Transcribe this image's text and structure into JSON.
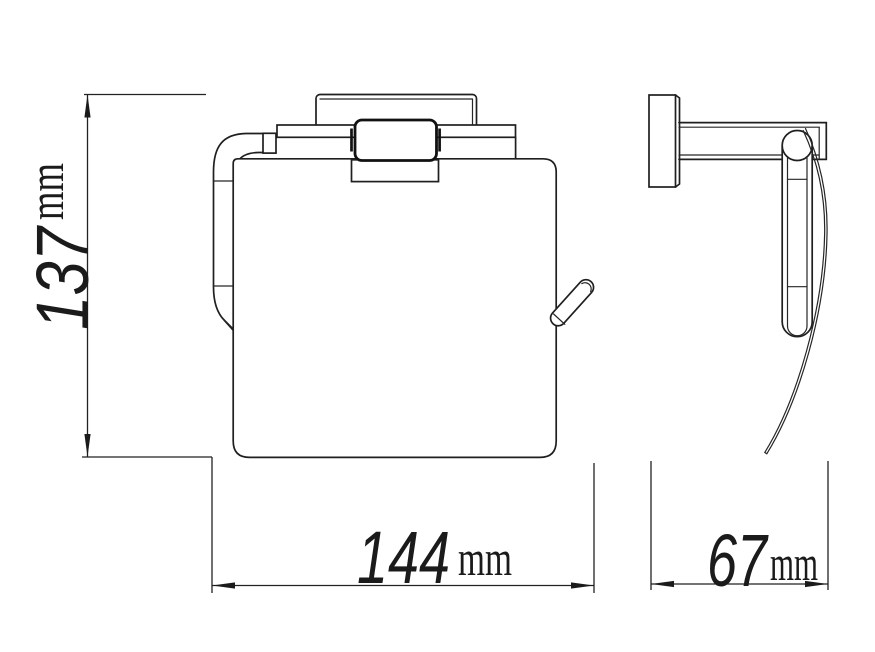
{
  "page": {
    "background_color": "#ffffff",
    "line_color": "#1f1f1f"
  },
  "drawing": {
    "height_dimension": {
      "value": "137",
      "unit": "mm"
    },
    "width_dimension": {
      "value": "144",
      "unit": "mm"
    },
    "depth_dimension": {
      "value": "67",
      "unit": "mm"
    }
  }
}
